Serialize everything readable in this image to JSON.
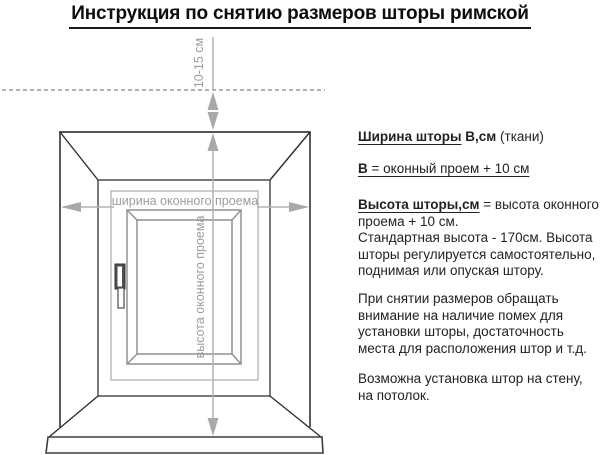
{
  "title": "Инструкция по снятию размеров шторы римской",
  "diagram": {
    "labels": {
      "offset_above_window": "10-15 см",
      "opening_width": "ширина оконного проема",
      "opening_height": "высота оконного проема"
    },
    "colors": {
      "window_outline": "#3d3d3d",
      "frame_gray": "#9a9a9a",
      "dimension_gray": "#a9a9a9",
      "label_gray": "#9d9d9d"
    }
  },
  "info": {
    "width_heading": {
      "underlined_bold": "Ширина шторы",
      "bold_tail": " В,см",
      "normal_tail": " (ткани)"
    },
    "width_formula": {
      "bold_lead": "В",
      "rest": " = оконный проем + 10 см"
    },
    "height_section": {
      "heading_bold": "Высота шторы,см",
      "heading_rest": " = высота оконного",
      "lines": [
        "проема + 10 см.",
        "Стандартная высота - 170см. Высота",
        "шторы регулируется самостоятельно,",
        "поднимая или опуская штору."
      ]
    },
    "note_measuring": {
      "lines": [
        "При снятии размеров обращать",
        "внимание на наличие помех для",
        "установки шторы, достаточность",
        "места для расположения штор и т.д."
      ]
    },
    "note_mounting": {
      "lines": [
        "Возможна установка штор на стену,",
        "на потолок."
      ]
    }
  }
}
